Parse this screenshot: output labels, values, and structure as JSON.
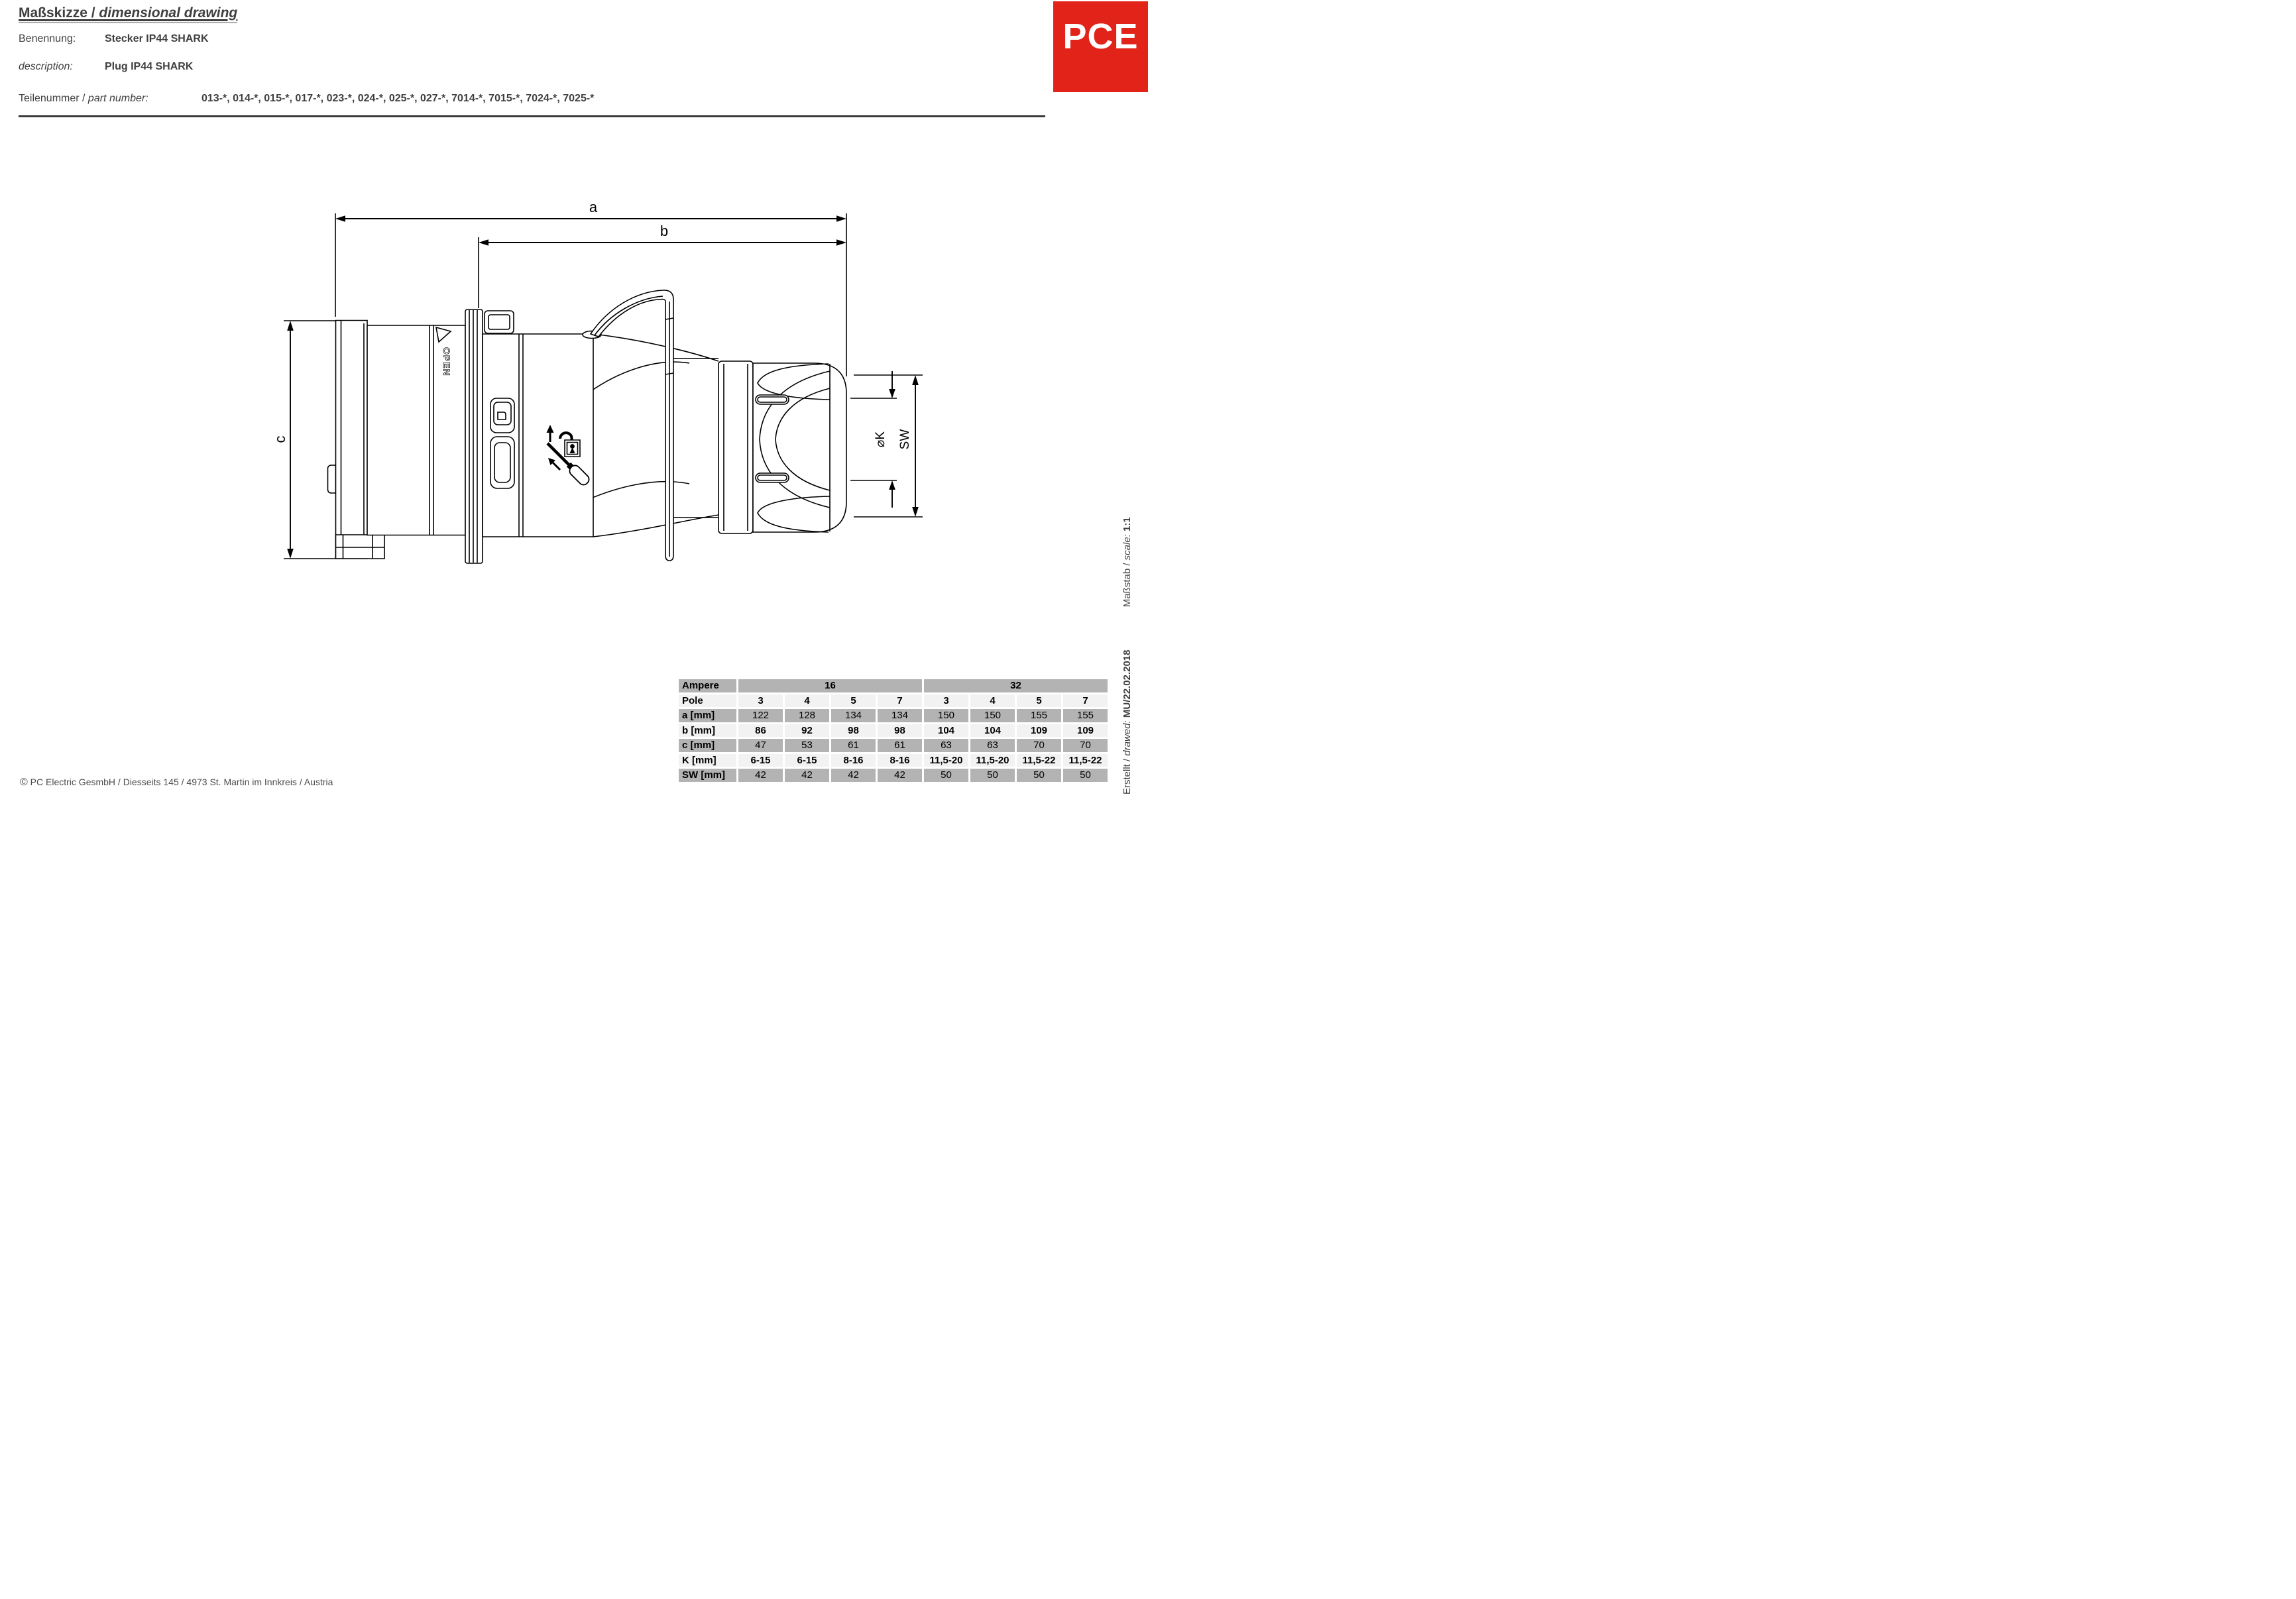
{
  "header": {
    "title_de": "Maßskizze / ",
    "title_en": "dimensional drawing",
    "benennung_label": "Benennung:",
    "benennung_value": "Stecker IP44 SHARK",
    "description_label": "description:",
    "description_value": "Plug IP44 SHARK",
    "part_label_de": "Teilenummer / ",
    "part_label_en": "part number:",
    "part_numbers": "013-*, 014-*, 015-*, 017-*, 023-*, 024-*, 025-*, 027-*, 7014-*, 7015-*, 7024-*, 7025-*"
  },
  "logo": {
    "text": "PCE",
    "bg": "#e2231a",
    "fg": "#ffffff"
  },
  "drawing": {
    "dim_a": "a",
    "dim_b": "b",
    "dim_c": "c",
    "dim_k": "⌀K",
    "dim_sw": "SW",
    "open_label": "OPEN"
  },
  "table": {
    "ampere_label": "Ampere",
    "current_16": "16",
    "current_32": "32",
    "pole_label": "Pole",
    "pole_values": [
      "3",
      "4",
      "5",
      "7",
      "3",
      "4",
      "5",
      "7"
    ],
    "rows": [
      {
        "label": "a [mm]",
        "values": [
          "122",
          "128",
          "134",
          "134",
          "150",
          "150",
          "155",
          "155"
        ]
      },
      {
        "label": "b [mm]",
        "values": [
          "86",
          "92",
          "98",
          "98",
          "104",
          "104",
          "109",
          "109"
        ]
      },
      {
        "label": "c [mm]",
        "values": [
          "47",
          "53",
          "61",
          "61",
          "63",
          "63",
          "70",
          "70"
        ]
      },
      {
        "label": "K [mm]",
        "values": [
          "6-15",
          "6-15",
          "8-16",
          "8-16",
          "11,5-20",
          "11,5-20",
          "11,5-22",
          "11,5-22"
        ]
      },
      {
        "label": "SW [mm]",
        "values": [
          "42",
          "42",
          "42",
          "42",
          "50",
          "50",
          "50",
          "50"
        ]
      }
    ]
  },
  "footer": {
    "copyright_symbol": "©",
    "copyright": " PC Electric GesmbH / Diesseits 145 / 4973 St. Martin im Innkreis / Austria"
  },
  "sidebar": {
    "created_prefix": "Erstellt / ",
    "created_italic": "drawed:",
    "created_value": "MU/22.02.2018",
    "scale_prefix": "Maßstab / ",
    "scale_italic": "scale:",
    "scale_value": "1:1"
  }
}
